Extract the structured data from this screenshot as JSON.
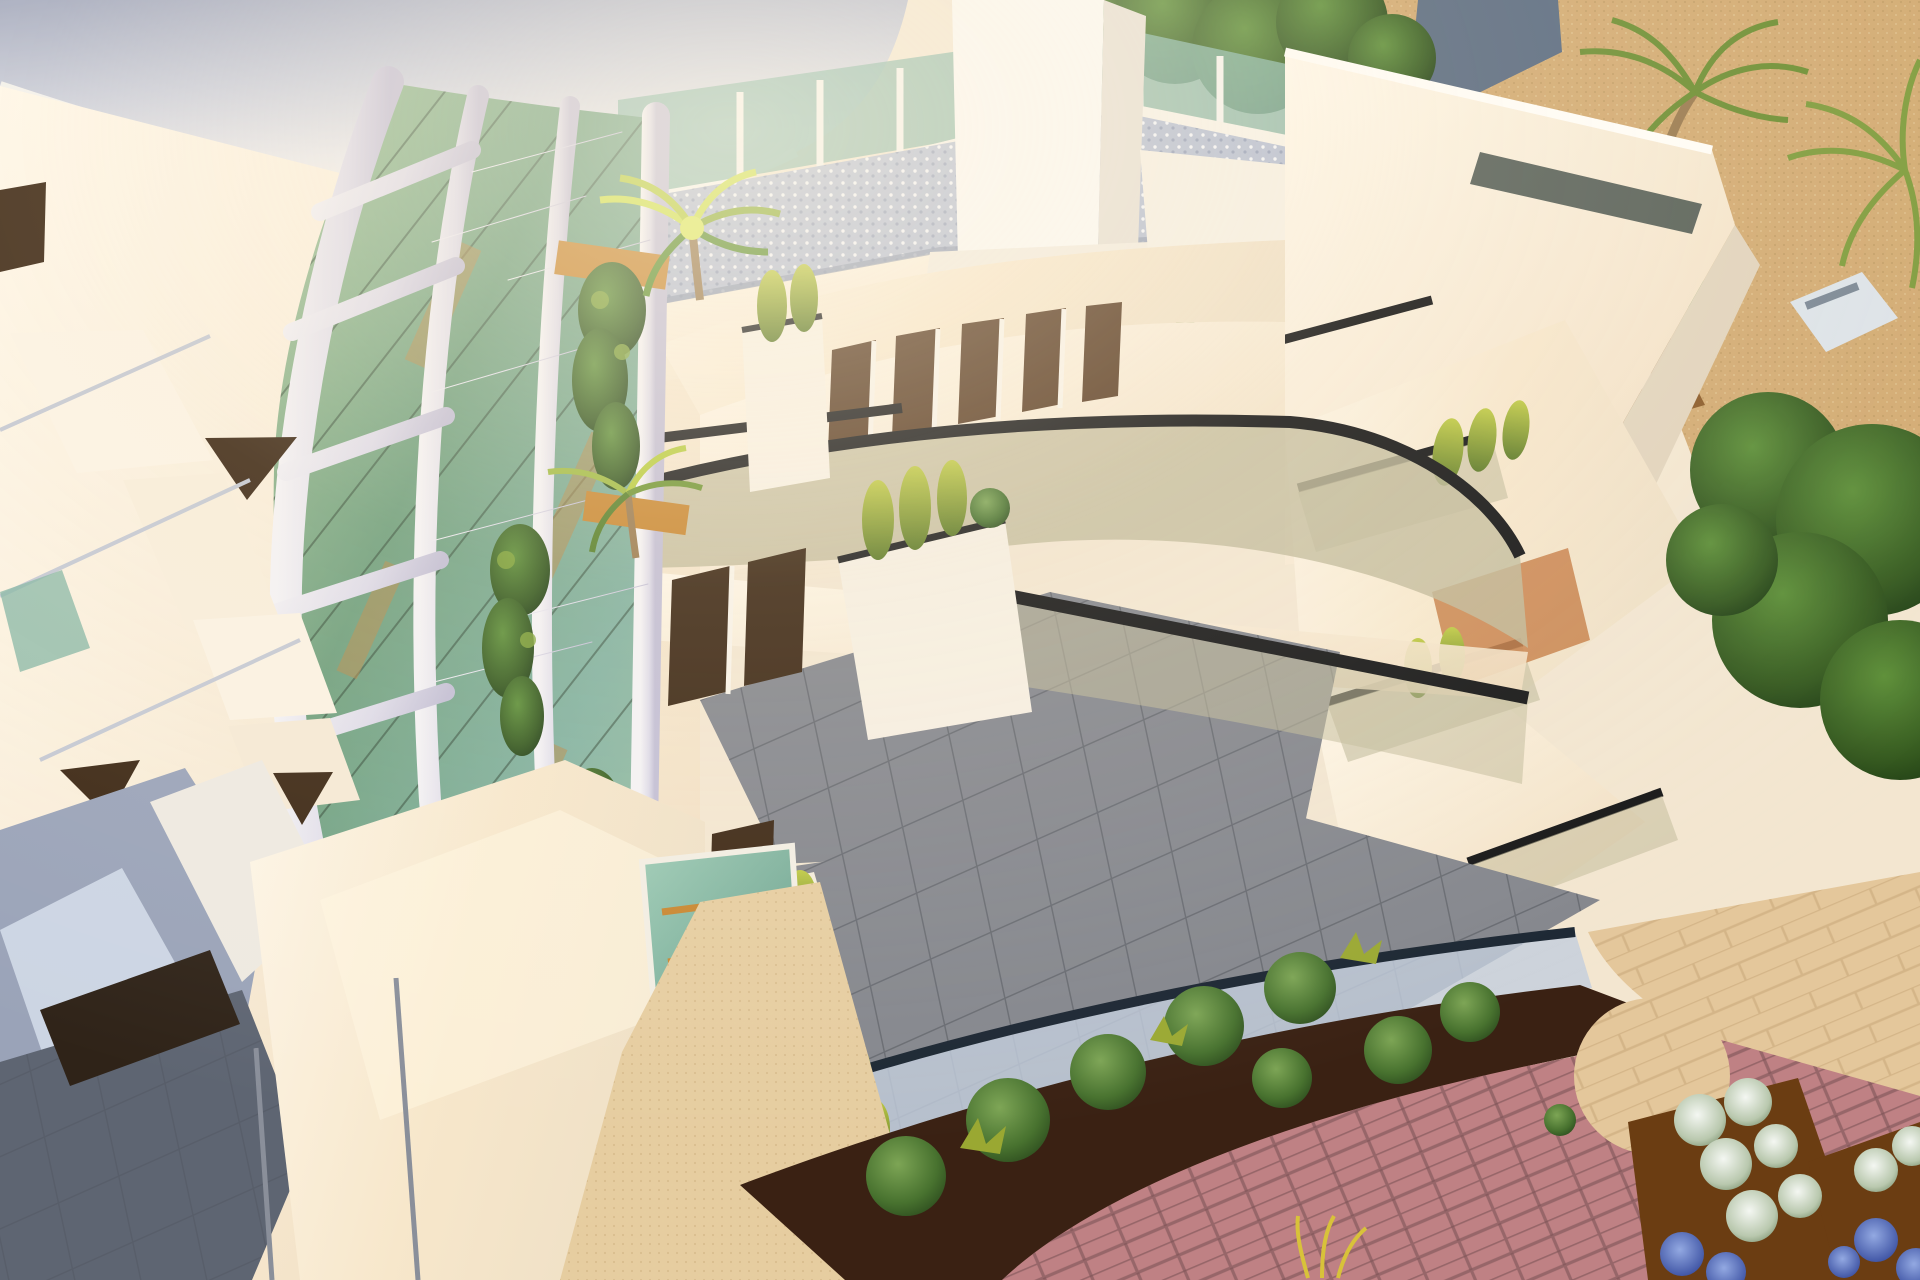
{
  "scene": {
    "type": "3d-architectural-rendering",
    "subject": "Aerial corner view of a modern white apartment building with organic perforated lattice tower, stepped balconies with curved glass railings, roof terrace and landscaped garden",
    "lighting": "warm low sun from upper left",
    "landscape": "sand-coloured ground, round clipped bushes in dark mulch, pink brick and beige stone paving, palm trees, flower beds"
  },
  "palette": {
    "cream_wall": "#f3e6d0",
    "cream_bright": "#fdf4e2",
    "white_pure": "#fbf9f3",
    "lattice_white": "#dedbe8",
    "lattice_deep": "#c5c1d6",
    "glass_green": "#7fae86",
    "glass_teal": "#86b5a4",
    "glass_khaki": "#c2bb9b",
    "glass_blue_pale": "#c3cedd",
    "rail_black": "#171717",
    "rail_dark_blue": "#1c2733",
    "door_bronze": "#5a3c22",
    "door_deep": "#3c2713",
    "tile_gray": "#85878d",
    "tile_dark": "#62656d",
    "roof_gravel": "#b7bfd1",
    "sand_tan": "#d3ab72",
    "path_beige": "#e6cda0",
    "stone_beige": "#e4c79b",
    "brick_pink": "#bf8184",
    "mulch_brown": "#3a2113",
    "soil_brown": "#6b3d12",
    "tree_dark": "#2c4a20",
    "tree_mid": "#497a2b",
    "bush_green": "#527f32",
    "cypress_yellow": "#a8b23a",
    "vine_green": "#3f6120",
    "palm_bright": "#cfe04e",
    "wood_orange": "#c8862f",
    "flower_white": "#e9efe8",
    "flower_blue": "#4a63b4",
    "shadow_blue": "#9aa3b8",
    "shadow_floor": "#5e6572",
    "metal_gray": "#9aa0ab",
    "house_roof": "#5a6b80",
    "dirt_path": "#8a5a28"
  }
}
